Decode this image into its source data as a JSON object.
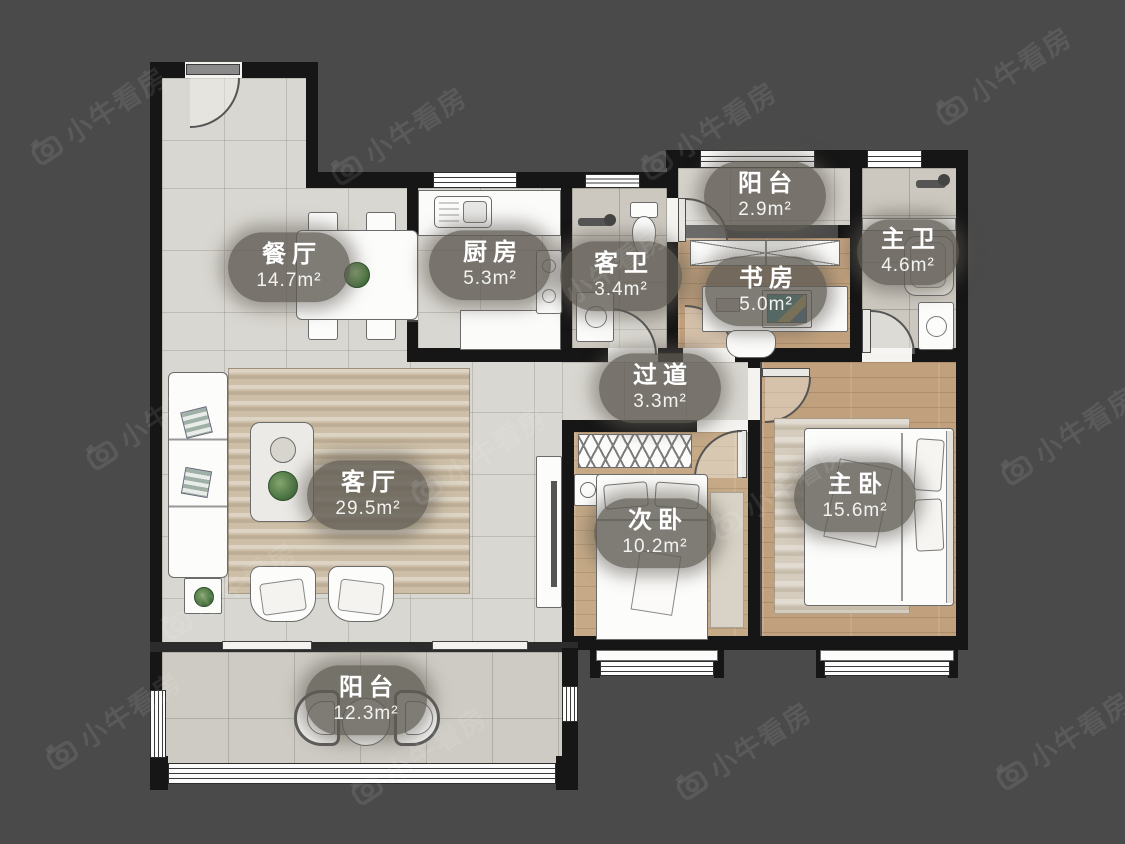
{
  "watermark": {
    "brand": "小牛看房"
  },
  "plan": {
    "rooms": [
      {
        "id": "dining",
        "name": "餐厅",
        "area": "14.7m²"
      },
      {
        "id": "kitchen",
        "name": "厨房",
        "area": "5.3m²"
      },
      {
        "id": "guest_bath",
        "name": "客卫",
        "area": "3.4m²"
      },
      {
        "id": "balcony_top",
        "name": "阳台",
        "area": "2.9m²"
      },
      {
        "id": "study",
        "name": "书房",
        "area": "5.0m²"
      },
      {
        "id": "master_bath",
        "name": "主卫",
        "area": "4.6m²"
      },
      {
        "id": "hallway",
        "name": "过道",
        "area": "3.3m²"
      },
      {
        "id": "living",
        "name": "客厅",
        "area": "29.5m²"
      },
      {
        "id": "second_bedroom",
        "name": "次卧",
        "area": "10.2m²"
      },
      {
        "id": "master_bedroom",
        "name": "主卧",
        "area": "15.6m²"
      },
      {
        "id": "balcony_bottom",
        "name": "阳台",
        "area": "12.3m²"
      }
    ]
  }
}
